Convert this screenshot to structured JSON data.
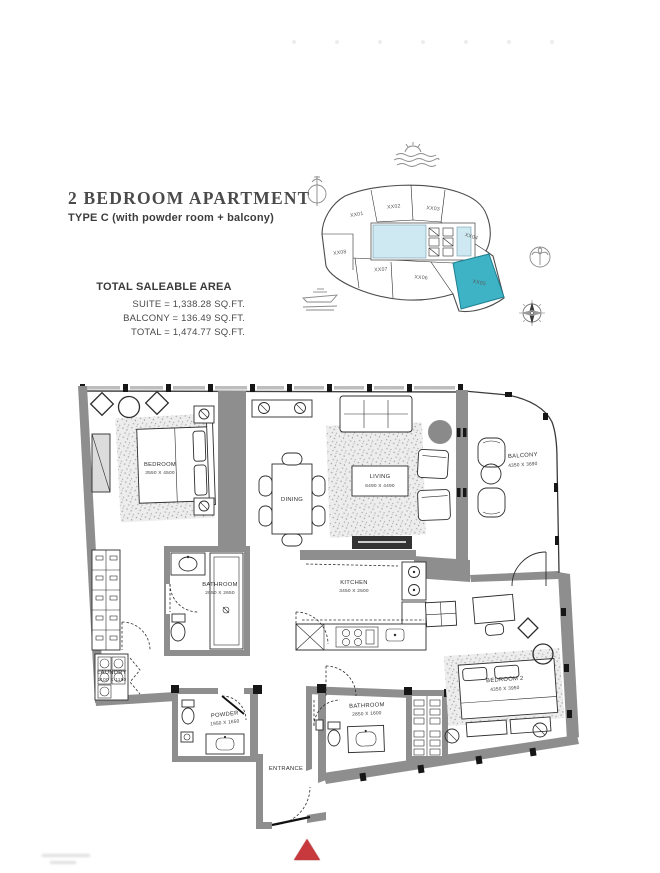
{
  "header": {
    "title": "2 BEDROOM APARTMENT",
    "subtitle": "TYPE C (with powder room + balcony)"
  },
  "area_table": {
    "heading": "TOTAL SALEABLE AREA",
    "rows": [
      "SUITE = 1,338.28 SQ.FT.",
      "BALCONY = 136.49 SQ.FT.",
      "TOTAL = 1,474.77 SQ.FT."
    ]
  },
  "key_plan": {
    "units": [
      "XX01",
      "XX02",
      "XX03",
      "XX04",
      "XX08",
      "XX07",
      "XX06",
      "XX05"
    ],
    "highlighted_unit": "XX05",
    "colors": {
      "highlight": "#3db3c5",
      "core": "#cfe9f2"
    },
    "icons": [
      "sea-waves-icon",
      "antenna-icon",
      "palm-tree-icon",
      "yacht-icon",
      "compass-icon"
    ]
  },
  "floor_plan": {
    "wall_color": "#8e8e8e",
    "entrance_marker_color": "#c8393e",
    "rooms": [
      {
        "name": "BEDROOM",
        "dims": "3550 X 4500"
      },
      {
        "name": "DINING",
        "dims": ""
      },
      {
        "name": "LIVING",
        "dims": "6490 X 4490"
      },
      {
        "name": "BALCONY",
        "dims": "4350 X 3690"
      },
      {
        "name": "BATHROOM",
        "dims": "2050 X 2650"
      },
      {
        "name": "KITCHEN",
        "dims": "3450 X 2500"
      },
      {
        "name": "LAUNDRY",
        "dims": "1100 X 1150"
      },
      {
        "name": "POWDER",
        "dims": "1950 X 1650"
      },
      {
        "name": "BATHROOM",
        "dims": "2850 X 1600"
      },
      {
        "name": "BEDROOM 2",
        "dims": "4350 X 3950"
      },
      {
        "name": "ENTRANCE",
        "dims": ""
      }
    ]
  }
}
